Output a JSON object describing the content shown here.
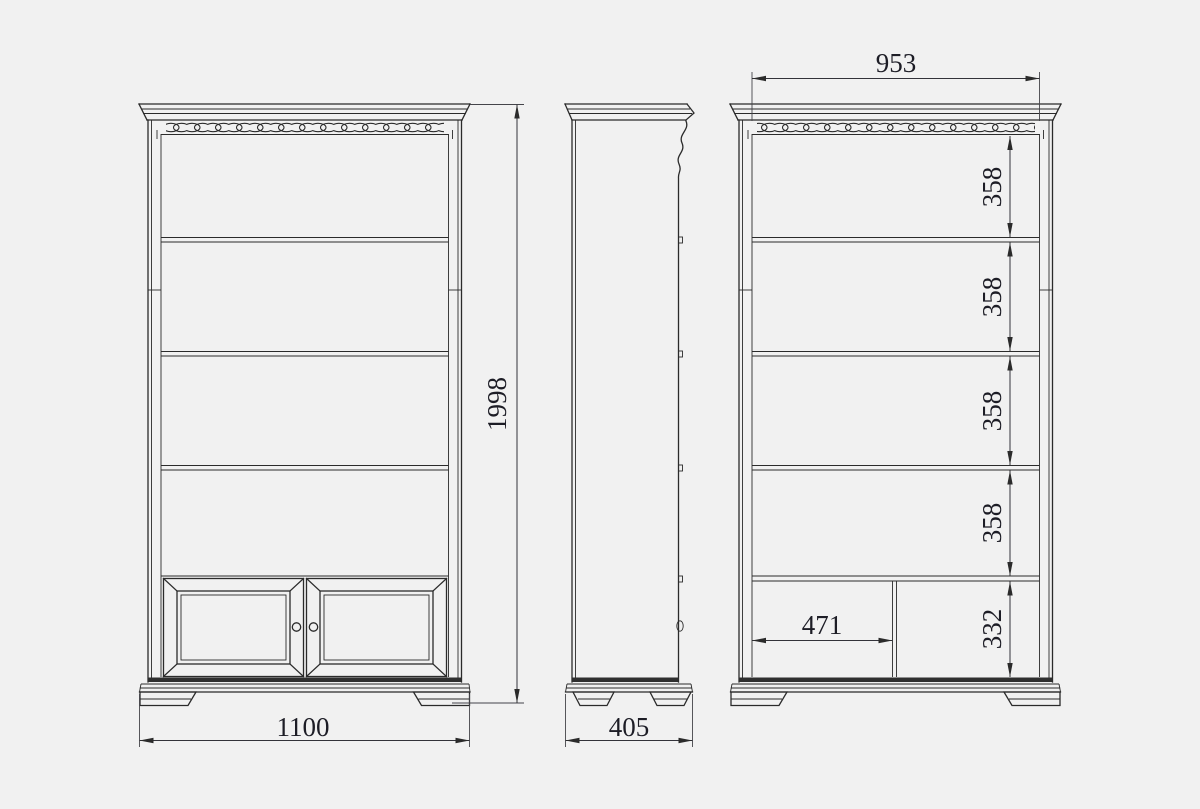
{
  "page": {
    "background": "#f1f1f1"
  },
  "drawing": {
    "title": "bookcase three-view dimension drawing",
    "subject": "open bookcase with decorative cornice, lattice frieze, four shelves and two-door base cabinet",
    "line_color": "#2b2b2b",
    "text_color": "#1d1d26",
    "views": {
      "front": {
        "name": "front view",
        "width_mm": "1100",
        "height_mm": "1998"
      },
      "side": {
        "name": "side view",
        "depth_mm": "405"
      },
      "internal": {
        "name": "front view with internal dimensions",
        "inner_width_mm": "953",
        "shelf_gaps_mm": [
          "358",
          "358",
          "358",
          "358"
        ],
        "door_compartment_width_mm": "471",
        "door_compartment_height_mm": "332"
      }
    }
  }
}
